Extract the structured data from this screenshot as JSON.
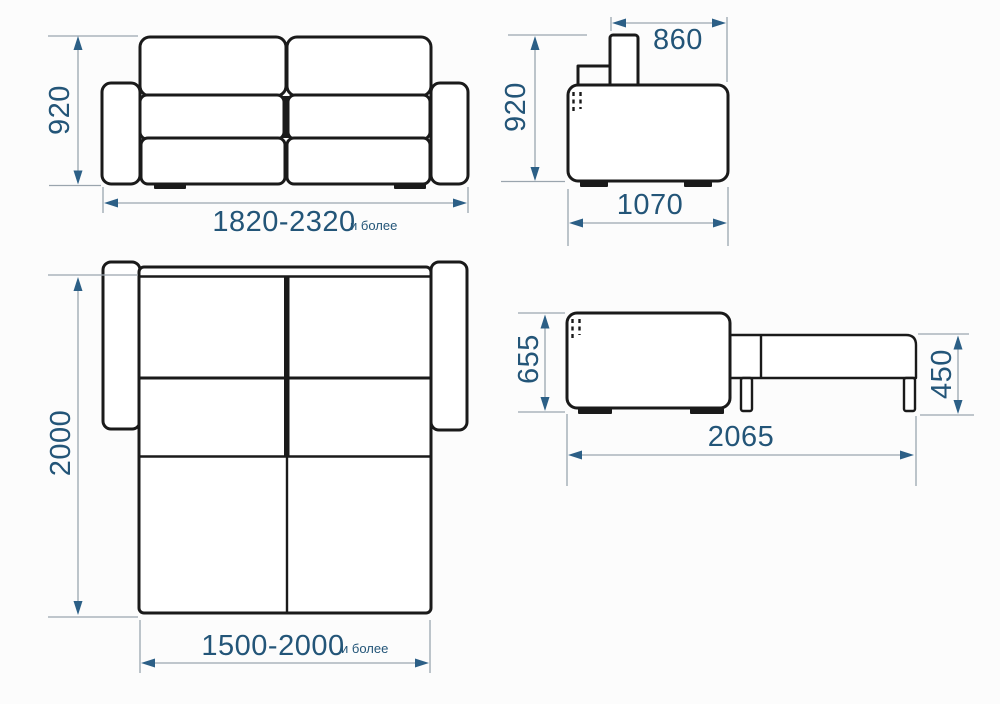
{
  "colors": {
    "outline": "#1a1a1a",
    "dim_line": "#9aa5ae",
    "dim_arrow": "#2c5f86",
    "dim_text": "#235578",
    "background": "#fcfcfc"
  },
  "views": {
    "front_folded": {
      "height": "920",
      "width": "1820-2320",
      "width_suffix": "и более"
    },
    "side_folded": {
      "back_width": "860",
      "height": "920",
      "depth": "1070"
    },
    "top_unfolded": {
      "length": "2000",
      "width": "1500-2000",
      "width_suffix": "и более"
    },
    "side_unfolded": {
      "seat_height": "655",
      "bed_height": "450",
      "length": "2065"
    }
  }
}
